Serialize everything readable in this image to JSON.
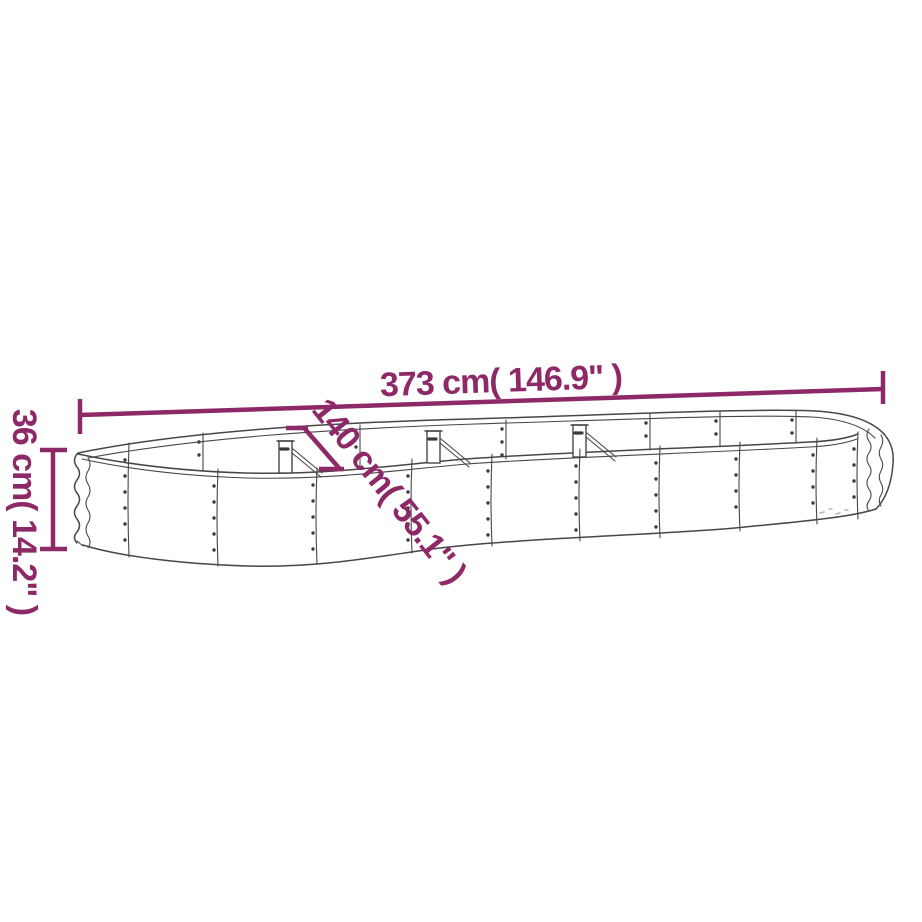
{
  "page": {
    "background": "#ffffff"
  },
  "diagram": {
    "type": "product-dimension-diagram",
    "subject": "oval corrugated-metal raised garden bed, perspective line drawing",
    "dimensions": {
      "length": {
        "label": "373 cm( 146.9\" )"
      },
      "width": {
        "label": "140 cm( 55.1\" )"
      },
      "height": {
        "label": "36 cm( 14.2\" )"
      }
    },
    "colors": {
      "dimension_accent": "#8e2968",
      "line_art": "#474747",
      "rivet": "#3b3b3b"
    }
  }
}
